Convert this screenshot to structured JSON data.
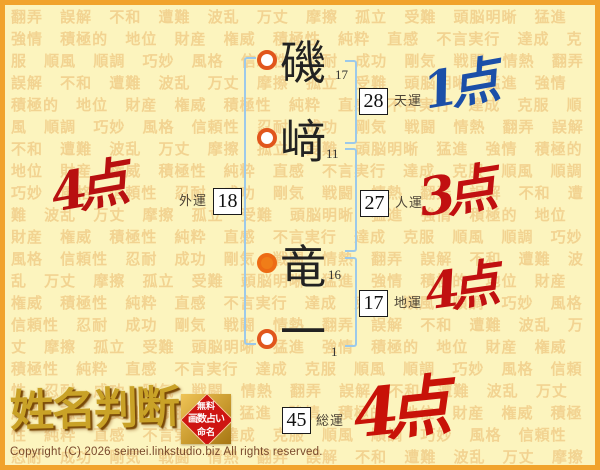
{
  "background": {
    "words": [
      "翻弄",
      "誤解",
      "不和",
      "遭難",
      "波乱",
      "万丈",
      "摩擦",
      "孤立",
      "受難",
      "頭脳明晰",
      "猛進",
      "強情",
      "積極的",
      "地位",
      "財産",
      "権威",
      "積極性",
      "純粋",
      "直感",
      "不言実行",
      "達成",
      "克服",
      "順風",
      "順調",
      "巧妙",
      "風格",
      "信頼性",
      "忍耐",
      "成功",
      "剛気",
      "戦闘",
      "情熱"
    ],
    "word_color": "#F2D391",
    "page_color": "#FCF4BE",
    "border_color": "#F1A32C"
  },
  "name": {
    "full": "磯﨑竜一",
    "characters": [
      {
        "char": "磯",
        "strokes": "17",
        "marker": "hollow"
      },
      {
        "char": "﨑",
        "strokes": "11",
        "marker": "hollow"
      },
      {
        "char": "竜",
        "strokes": "16",
        "marker": "filled"
      },
      {
        "char": "一",
        "strokes": "1",
        "marker": "hollow"
      }
    ]
  },
  "fortunes": [
    {
      "label": "天運",
      "value": "28",
      "points": "1点",
      "points_color": "#1B4FA8"
    },
    {
      "label": "人運",
      "value": "27",
      "points": "3点",
      "points_color": "#C11010"
    },
    {
      "label": "地運",
      "value": "17",
      "points": "4点",
      "points_color": "#C11010"
    },
    {
      "label": "外運",
      "value": "18",
      "points": "4点",
      "points_color": "#B81010"
    },
    {
      "label": "総運",
      "value": "45",
      "points": "4点",
      "points_color": "#C81208"
    }
  ],
  "logo": {
    "title": "姓名判断",
    "badge": {
      "lines": [
        "無料",
        "画数占い",
        "命名"
      ],
      "bg_color": "#C99A2E",
      "diamond_color": "#CE1512",
      "text_color": "#FFFFFF"
    }
  },
  "footer": {
    "copyright": "Copyright (C) 2026 seimei.linkstudio.biz All rights reserved."
  }
}
